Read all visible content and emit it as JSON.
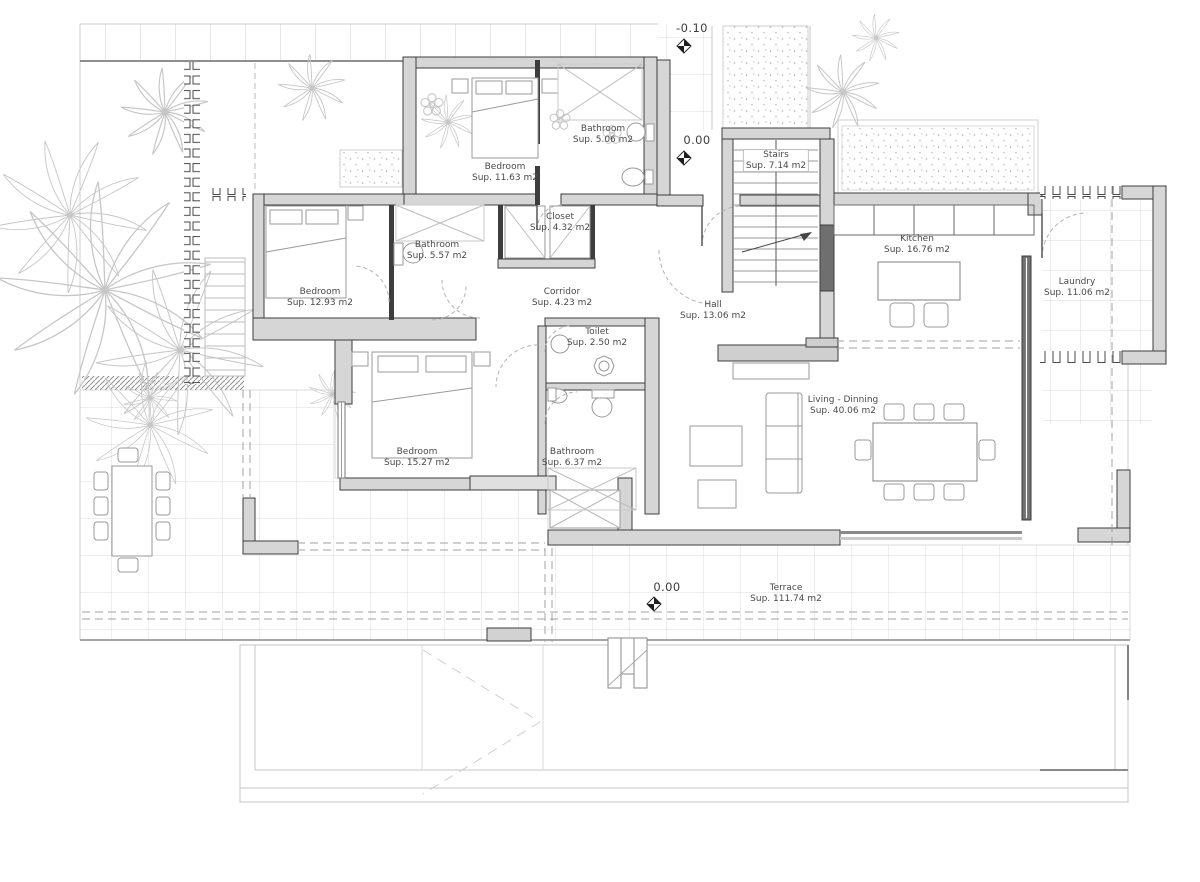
{
  "rooms": [
    {
      "name": "Bathroom",
      "area": "Sup. 5.06 m2"
    },
    {
      "name": "Bedroom",
      "area": "Sup. 11.63 m2"
    },
    {
      "name": "Stairs",
      "area": "Sup. 7.14 m2"
    },
    {
      "name": "Closet",
      "area": "Sup. 4.32 m2"
    },
    {
      "name": "Bathroom",
      "area": "Sup. 5.57 m2"
    },
    {
      "name": "Kitchen",
      "area": "Sup. 16.76 m2"
    },
    {
      "name": "Bedroom",
      "area": "Sup. 12.93 m2"
    },
    {
      "name": "Corridor",
      "area": "Sup. 4.23 m2"
    },
    {
      "name": "Laundry",
      "area": "Sup. 11.06 m2"
    },
    {
      "name": "Hall",
      "area": "Sup. 13.06 m2"
    },
    {
      "name": "Toilet",
      "area": "Sup. 2.50 m2"
    },
    {
      "name": "Living - Dinning",
      "area": "Sup. 40.06 m2"
    },
    {
      "name": "Bedroom",
      "area": "Sup. 15.27 m2"
    },
    {
      "name": "Bathroom",
      "area": "Sup. 6.37 m2"
    },
    {
      "name": "Terrace",
      "area": "Sup. 111.74 m2"
    }
  ],
  "levels": [
    {
      "value": "-0.10"
    },
    {
      "value": "0.00"
    },
    {
      "value": "0.00"
    }
  ],
  "colors": {
    "wall_fill": "#d6d6d6",
    "wall_line": "#3d3d3d",
    "grid_line": "#dcdcdc",
    "plant_line": "#c6c6c6",
    "label_text": "#4a4a4a"
  }
}
